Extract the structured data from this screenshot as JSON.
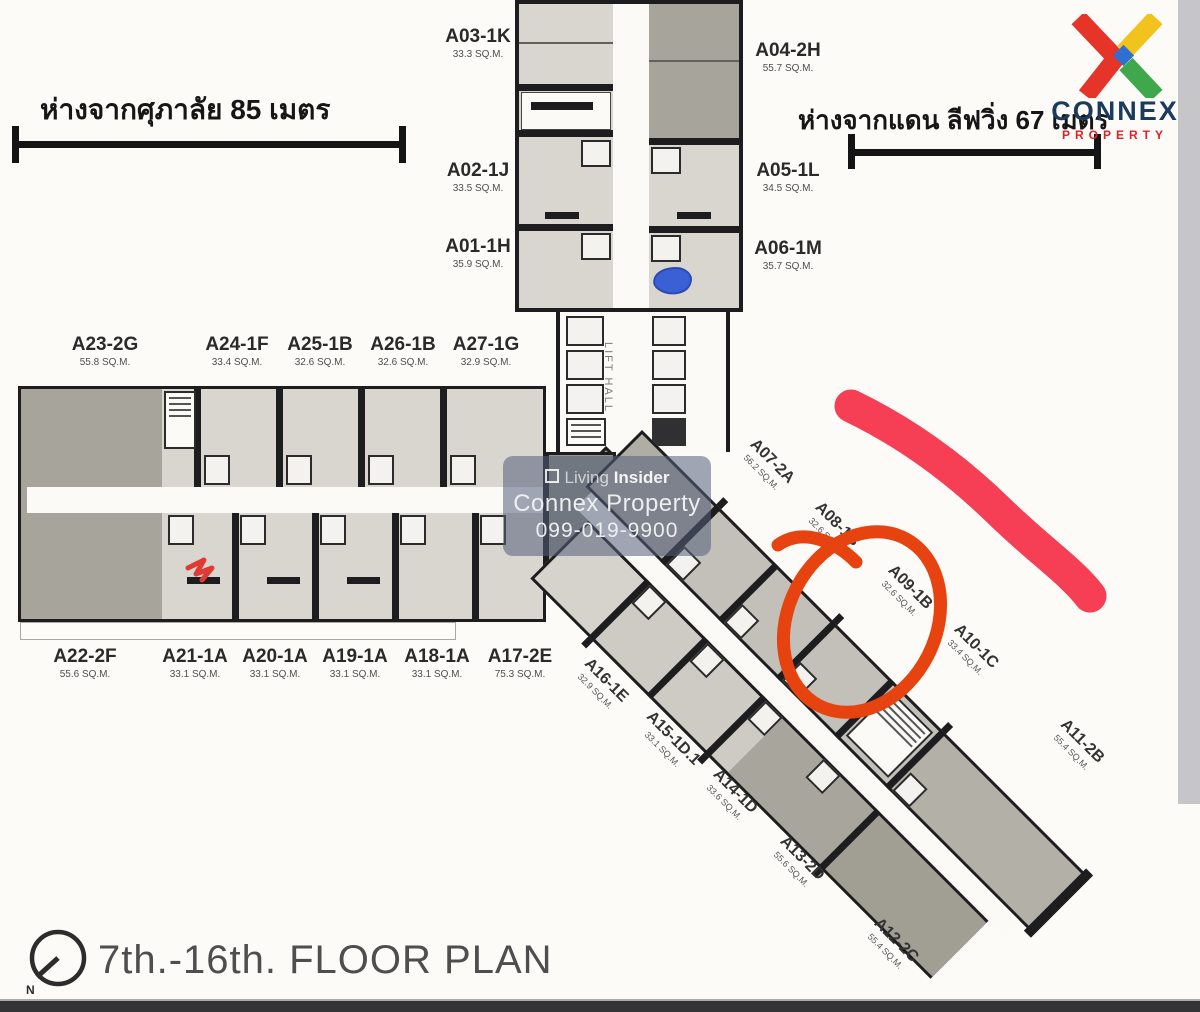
{
  "distance_markers": {
    "left": "ห่างจากศุภาลัย  85 เมตร",
    "right": "ห่างจากแดน  ลีฟวิ่ง  67 เมตร"
  },
  "logo": {
    "title": "CONNEX",
    "subtitle": "PROPERTY",
    "colors": {
      "red": "#e63429",
      "yellow": "#f2c21d",
      "green": "#3fa84c",
      "blue": "#2f6fd0",
      "navy": "#1c3a5c"
    }
  },
  "watermark": {
    "brand_light": "Living",
    "brand_bold": "Insider",
    "company": "Connex Property",
    "phone": "099-019-9900"
  },
  "lift_hall_label": "LIFT HALL",
  "footer": {
    "compass_letter": "N",
    "title": "7th.-16th. FLOOR PLAN"
  },
  "annotations": {
    "squiggle_color": "#f63e55",
    "circle_color": "#e64310",
    "small_red_color": "#df3a33",
    "blue_color": "#2e55d6",
    "circled_unit": "A09-1B"
  },
  "units": {
    "north_left": [
      {
        "code": "A03-1K",
        "area": "33.3 SQ.M."
      },
      {
        "code": "A02-1J",
        "area": "33.5 SQ.M."
      },
      {
        "code": "A01-1H",
        "area": "35.9 SQ.M."
      }
    ],
    "north_right": [
      {
        "code": "A04-2H",
        "area": "55.7 SQ.M."
      },
      {
        "code": "A05-1L",
        "area": "34.5 SQ.M."
      },
      {
        "code": "A06-1M",
        "area": "35.7 SQ.M."
      }
    ],
    "west_top": [
      {
        "code": "A23-2G",
        "area": "55.8 SQ.M."
      },
      {
        "code": "A24-1F",
        "area": "33.4 SQ.M."
      },
      {
        "code": "A25-1B",
        "area": "32.6 SQ.M."
      },
      {
        "code": "A26-1B",
        "area": "32.6 SQ.M."
      },
      {
        "code": "A27-1G",
        "area": "32.9 SQ.M."
      }
    ],
    "west_bottom": [
      {
        "code": "A22-2F",
        "area": "55.6 SQ.M."
      },
      {
        "code": "A21-1A",
        "area": "33.1 SQ.M."
      },
      {
        "code": "A20-1A",
        "area": "33.1 SQ.M."
      },
      {
        "code": "A19-1A",
        "area": "33.1 SQ.M."
      },
      {
        "code": "A18-1A",
        "area": "33.1 SQ.M."
      },
      {
        "code": "A17-2E",
        "area": "75.3 SQ.M."
      }
    ],
    "diag_upper": [
      {
        "code": "A07-2A",
        "area": "56.2 SQ.M."
      },
      {
        "code": "A08-1B",
        "area": "32.6 SQ.M."
      },
      {
        "code": "A09-1B",
        "area": "32.6 SQ.M."
      },
      {
        "code": "A10-1C",
        "area": "33.4 SQ.M."
      },
      {
        "code": "A11-2B",
        "area": "55.4 SQ.M."
      }
    ],
    "diag_lower": [
      {
        "code": "A16-1E",
        "area": "32.9 SQ.M."
      },
      {
        "code": "A15-1D.1",
        "area": "33.1 SQ.M."
      },
      {
        "code": "A14-1D",
        "area": "33.6 SQ.M."
      },
      {
        "code": "A13-2D",
        "area": "55.6 SQ.M."
      },
      {
        "code": "A12-2C",
        "area": "55.4 SQ.M."
      }
    ]
  }
}
